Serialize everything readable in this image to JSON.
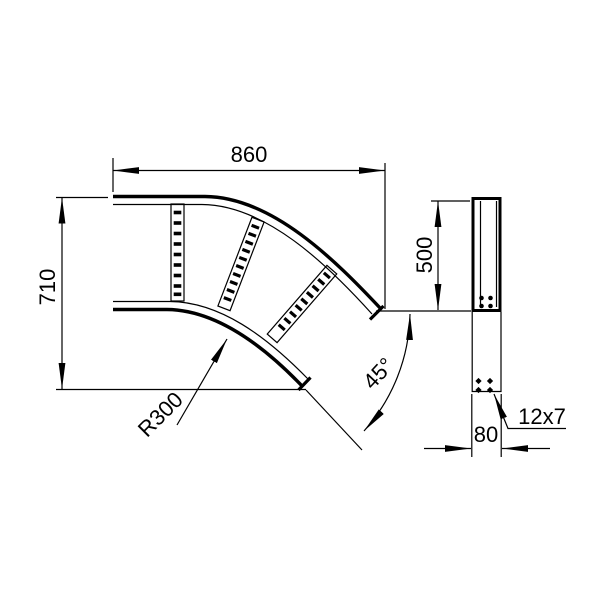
{
  "drawing": {
    "kind": "technical-drawing",
    "subject": "cable-ladder-45-degree-horizontal-bend",
    "colors": {
      "line": "#000000",
      "background": "#ffffff"
    },
    "dimensions": {
      "overall_width": "860",
      "overall_height": "710",
      "bend_radius": "R300",
      "bend_angle": "45°",
      "side_straight_length": "500",
      "side_width": "80",
      "slot_size": "12x7"
    }
  }
}
